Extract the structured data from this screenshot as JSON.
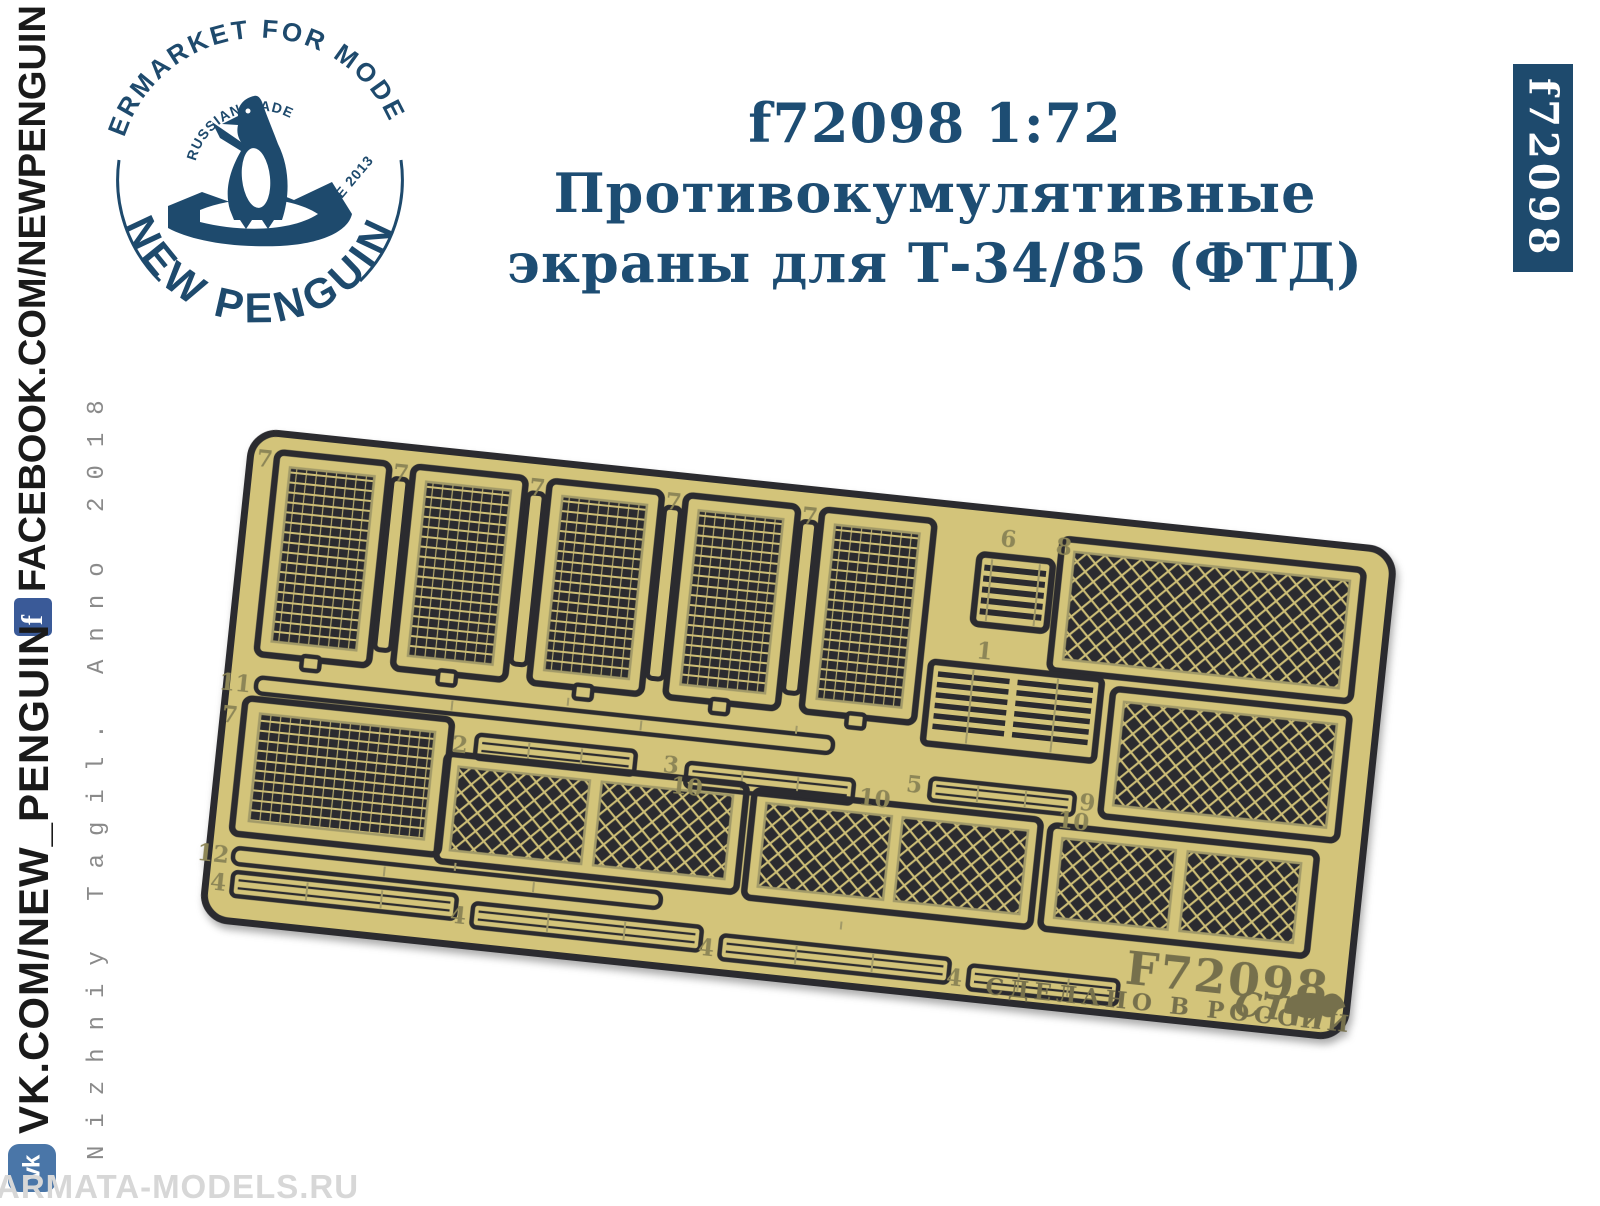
{
  "logo": {
    "arc_top": "AFTERMARKET FOR MODELING",
    "arc_bottom": "NEW PENGUIN",
    "inner_top": "RUSSIAN MADE",
    "inner_right": "SINCE 2013",
    "color": "#1e4a6d"
  },
  "title": {
    "line1": "f72098 1:72 Противокумулятивные",
    "line2": "экраны для Т-34/85 (ФТД)",
    "color": "#1d4d73"
  },
  "code_banner": {
    "text": "f72098",
    "bg": "#1e4a6d",
    "fg": "#ffffff"
  },
  "sidebar": {
    "fb_url": "FACEBOOK.COM/NEWPENGUIN",
    "fb_icon": "f",
    "vk_url": "VK.COM/NEW_PENGUIN",
    "vk_icon": "vk",
    "note": "Nizhniy Tagil. Anno 2018",
    "fb_color": "#3a5a98",
    "vk_color": "#4a76a8"
  },
  "watermark": {
    "text": "ARMATA-MODELS.RU"
  },
  "plate": {
    "brass_color": "#d3c47a",
    "etch_dark": "#2b2b2f",
    "label_color": "#8d8657",
    "code": "F72098",
    "made_in": "СДЕЛАНО В РОССИИ",
    "monogram": "СТ",
    "part_labels": [
      {
        "t": "7",
        "x": 26,
        "y": 38,
        "a": "end"
      },
      {
        "t": "7",
        "x": 163,
        "y": 38,
        "a": "end"
      },
      {
        "t": "7",
        "x": 300,
        "y": 38,
        "a": "end"
      },
      {
        "t": "7",
        "x": 437,
        "y": 38,
        "a": "end"
      },
      {
        "t": "7",
        "x": 574,
        "y": 38,
        "a": "end"
      },
      {
        "t": "6",
        "x": 766,
        "y": 40,
        "a": "middle"
      },
      {
        "t": "8",
        "x": 814,
        "y": 42,
        "a": "start"
      },
      {
        "t": "11",
        "x": 28,
        "y": 264,
        "a": "end"
      },
      {
        "t": "1",
        "x": 754,
        "y": 154,
        "a": "middle"
      },
      {
        "t": "2",
        "x": 250,
        "y": 302,
        "a": "end"
      },
      {
        "t": "3",
        "x": 462,
        "y": 300,
        "a": "end"
      },
      {
        "t": "10",
        "x": 488,
        "y": 320,
        "a": "end"
      },
      {
        "t": "10",
        "x": 676,
        "y": 312,
        "a": "end"
      },
      {
        "t": "5",
        "x": 706,
        "y": 294,
        "a": "end"
      },
      {
        "t": "9",
        "x": 880,
        "y": 294,
        "a": "end"
      },
      {
        "t": "10",
        "x": 876,
        "y": 314,
        "a": "end"
      },
      {
        "t": "7",
        "x": 2,
        "y": 296,
        "a": "start"
      },
      {
        "t": "12",
        "x": 24,
        "y": 436,
        "a": "end"
      },
      {
        "t": "4",
        "x": 24,
        "y": 464,
        "a": "end"
      },
      {
        "t": "4",
        "x": 266,
        "y": 472,
        "a": "end"
      },
      {
        "t": "4",
        "x": 516,
        "y": 478,
        "a": "end"
      },
      {
        "t": "4",
        "x": 766,
        "y": 482,
        "a": "end"
      }
    ]
  }
}
